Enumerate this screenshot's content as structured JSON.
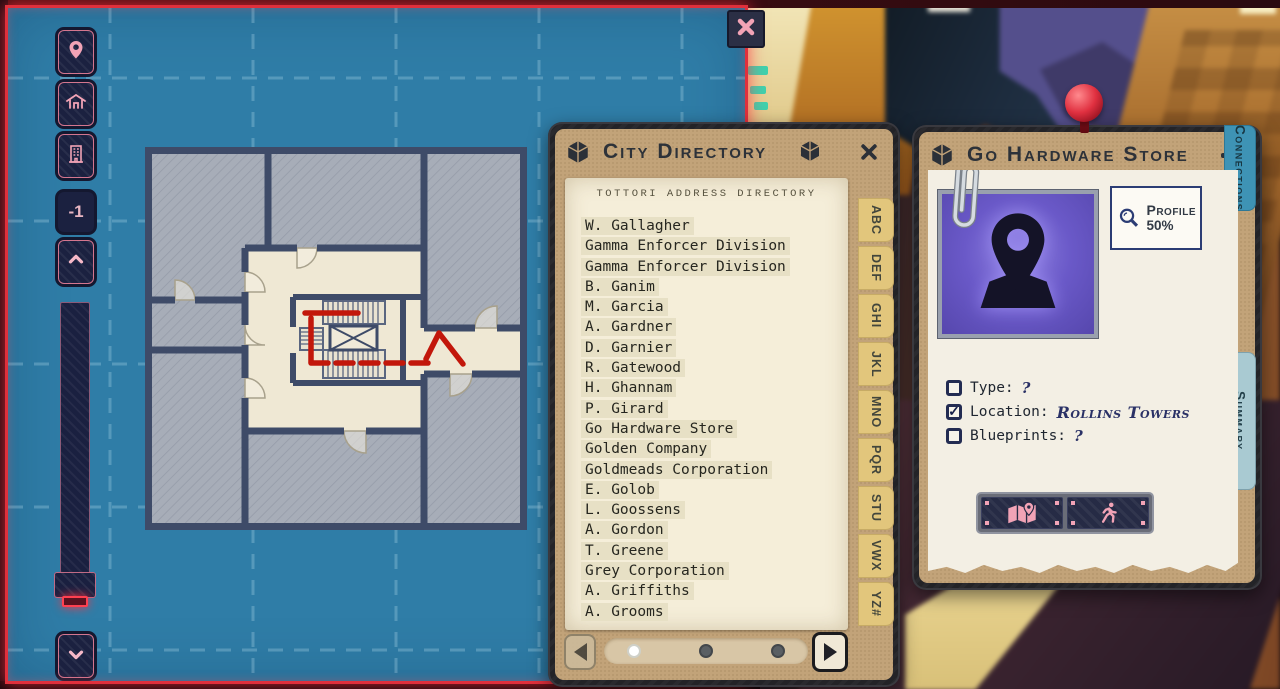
{
  "colors": {
    "accent_red": "#e0303c",
    "map_blue": "#2f7da7",
    "panel_tan": "#c2a379",
    "paper": "#f5eed9",
    "letter_tab_yellow": "#e2c67c",
    "tab_blue_active": "#a9cad2",
    "tab_blue": "#3e93b5",
    "photo_purple": "#6a59c8",
    "icon_pink": "#f2a3b6",
    "button_navy": "#1b2140",
    "path_red": "#c2170b"
  },
  "map_overlay": {
    "level_indicator": "-1",
    "sidebar_icons": [
      "location-pin-icon",
      "house-icon",
      "building-icon"
    ],
    "scroll_icons": [
      "chevron-up-icon",
      "chevron-down-icon"
    ],
    "close_icon": "x-icon"
  },
  "directory": {
    "title": "City Directory",
    "header_icon": "cube-icon",
    "corner_icon": "cube-icon",
    "close_icon": "x-icon",
    "paper_title": "TOTTORI ADDRESS DIRECTORY",
    "entries": [
      "W. Gallagher",
      "Gamma Enforcer Division",
      "Gamma Enforcer Division",
      "B. Ganim",
      "M. Garcia",
      "A. Gardner",
      "D. Garnier",
      "R. Gatewood",
      "H. Ghannam",
      "P. Girard",
      "Go Hardware Store",
      "Golden Company",
      "Goldmeads Corporation",
      "E. Golob",
      "L. Goossens",
      "A. Gordon",
      "T. Greene",
      "Grey Corporation",
      "A. Griffiths",
      "A. Grooms"
    ],
    "letter_tabs": [
      "ABC",
      "DEF",
      "GHI",
      "JKL",
      "MNO",
      "PQR",
      "STU",
      "VWX",
      "YZ#"
    ],
    "pagination": {
      "dots": [
        {
          "active": true
        },
        {},
        {}
      ],
      "prev_icon": "arrow-left-icon",
      "next_icon": "arrow-right-icon"
    }
  },
  "profile_panel": {
    "title": "Go Hardware Store",
    "header_icon": "cube-icon",
    "minimize_icon": "minus-icon",
    "photo_icon": "location-pin-icon",
    "pin_icon": "red-pushpin-icon",
    "profile": {
      "icon": "magnifier-icon",
      "label": "Profile",
      "value": "50%"
    },
    "fields": [
      {
        "label": "Type:",
        "value": "?"
      },
      {
        "label": "Location:",
        "value": "Rollins Towers",
        "checked": true,
        "handwritten": true
      },
      {
        "label": "Blueprints:",
        "value": "?"
      }
    ],
    "tabs": [
      {
        "label": "Summary",
        "active": true
      },
      {
        "label": "Connections"
      }
    ],
    "actions": [
      {
        "icon": "map-location-icon"
      },
      {
        "icon": "run-icon"
      }
    ]
  }
}
